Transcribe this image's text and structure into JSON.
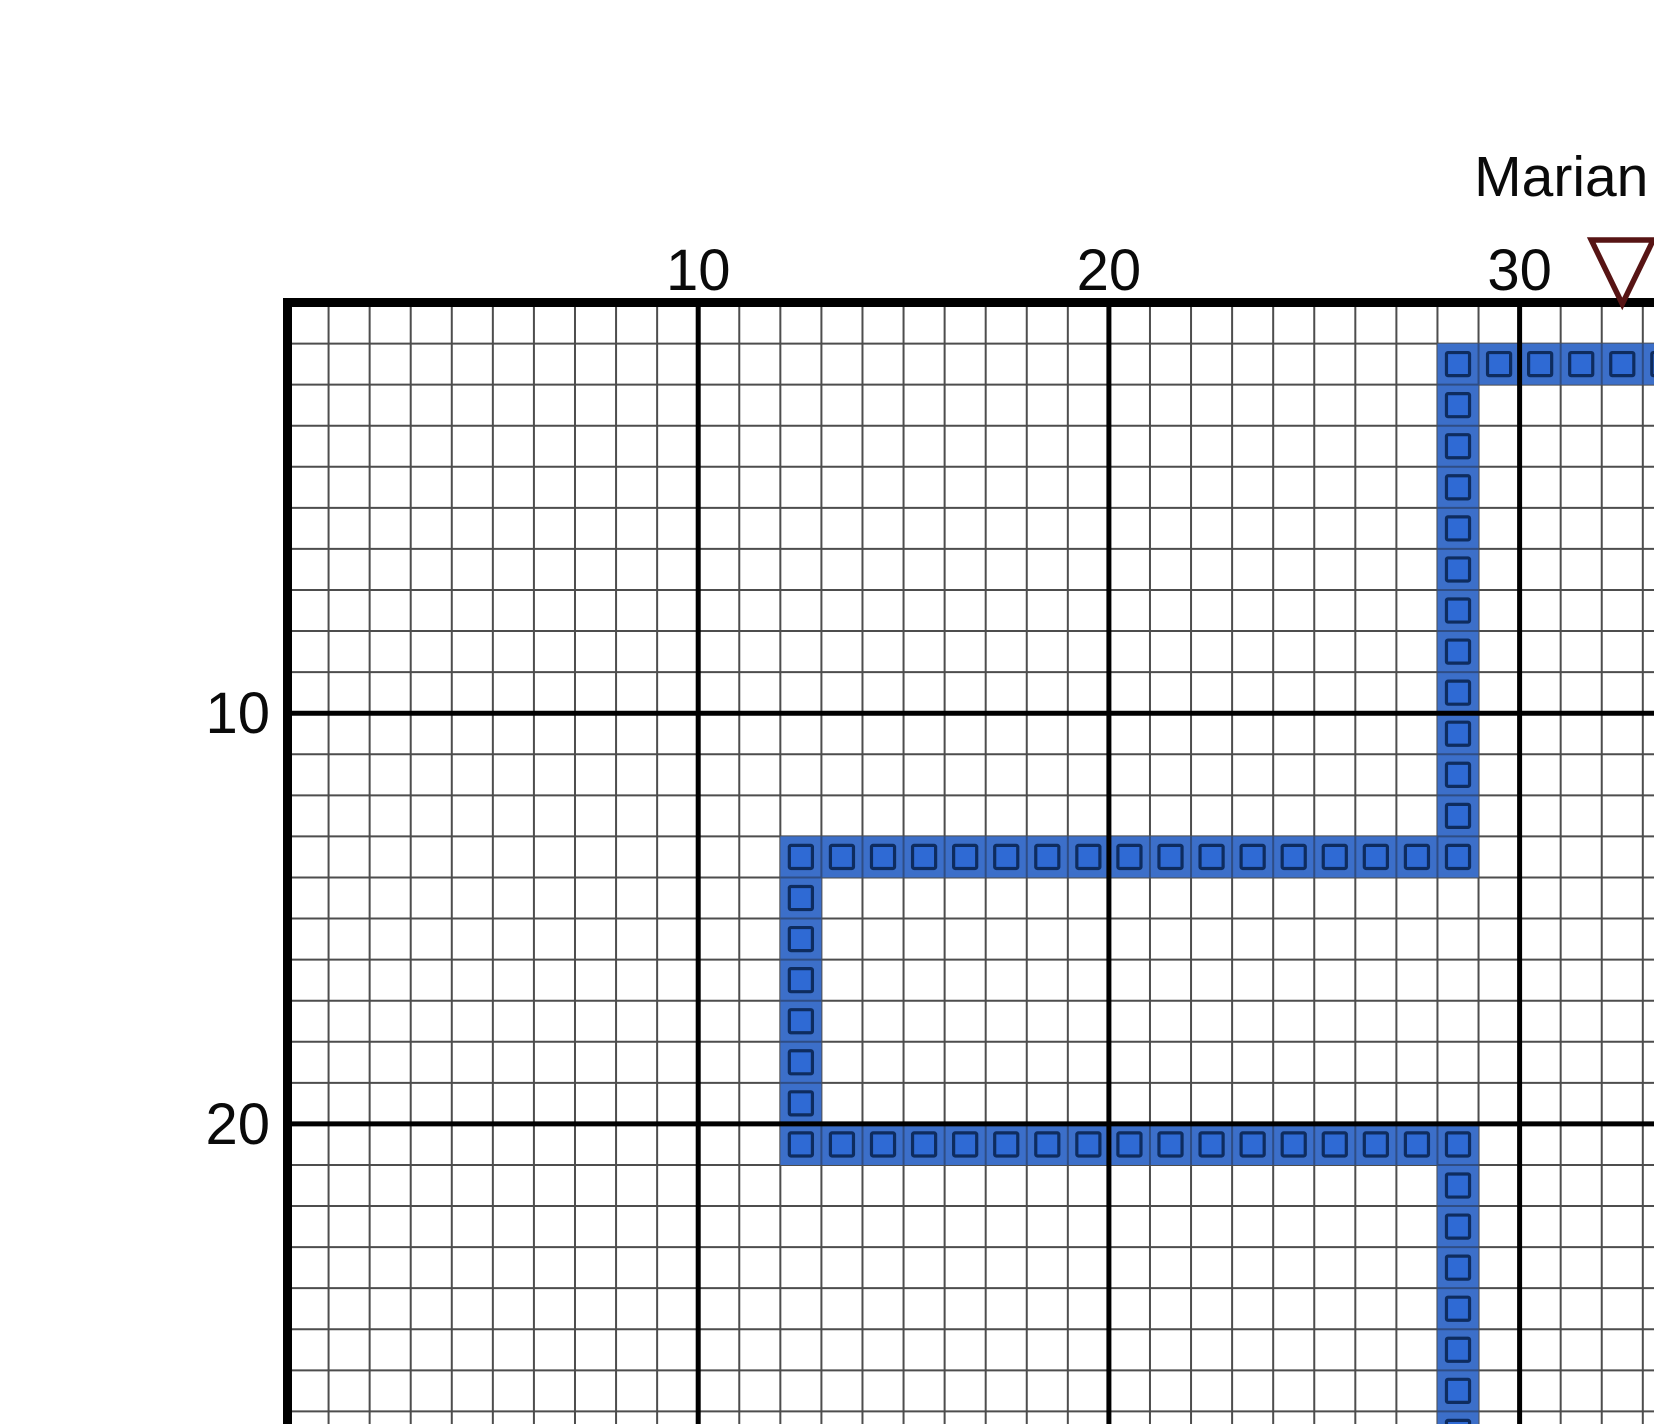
{
  "player": {
    "name": "Marian",
    "marker_icon": "down-triangle",
    "marker_column": 33,
    "marker_color": "#571414",
    "marker_fill": "#ffffff"
  },
  "axis_labels": {
    "top": [
      {
        "text": "10",
        "col": 10
      },
      {
        "text": "20",
        "col": 20
      },
      {
        "text": "30",
        "col": 30
      }
    ],
    "left": [
      {
        "text": "10",
        "row": 10
      },
      {
        "text": "20",
        "row": 20
      }
    ]
  },
  "grid": {
    "major_every": 10,
    "background": "#ffffff",
    "minor_line_color": "#4d4d4d",
    "major_line_color": "#000000",
    "border_color": "#000000"
  },
  "trail": {
    "owner": "Marian",
    "cell_fill": "#3c6fc9",
    "inner_square_fill": "#2f6ad4",
    "inner_square_stroke": "#0e2c5f",
    "seam_color": "#2e4d85",
    "segments": [
      {
        "dir": "h",
        "row": 2,
        "from": 29,
        "to": 34
      },
      {
        "dir": "v",
        "col": 29,
        "from": 3,
        "to": 13
      },
      {
        "dir": "h",
        "row": 14,
        "from": 13,
        "to": 29
      },
      {
        "dir": "v",
        "col": 13,
        "from": 15,
        "to": 20
      },
      {
        "dir": "h",
        "row": 21,
        "from": 13,
        "to": 29
      },
      {
        "dir": "v",
        "col": 29,
        "from": 22,
        "to": 28
      }
    ]
  }
}
